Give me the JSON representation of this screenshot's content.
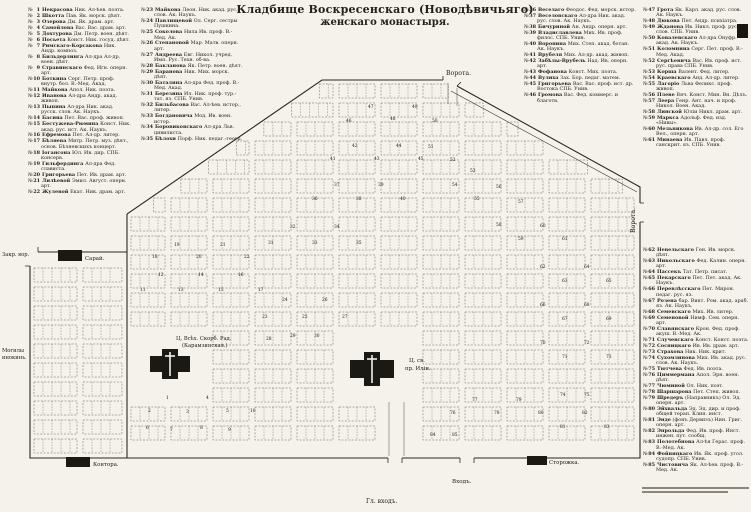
{
  "title": {
    "line1": "Кладбище Воскресенскаго (Новодѣвичьяго)",
    "line2": "женскаго монастыря."
  },
  "list_marker": "№",
  "columns": {
    "col1": {
      "from": 1,
      "to": 22
    },
    "col2": {
      "from": 23,
      "to": 35
    },
    "col3": {
      "from": 36,
      "to": 46
    },
    "col4a": {
      "from": 47,
      "to": 61
    },
    "col4b": {
      "from": 62,
      "to": 85
    }
  },
  "graves": [
    {
      "n": 1,
      "name": "Некрасова",
      "info": "Ник. Ал-ѣев. поэта."
    },
    {
      "n": 2,
      "name": "Шкотта",
      "info": "Пав. Як. морск. дѣят."
    },
    {
      "n": 3,
      "name": "Озерова",
      "info": "Дм. Як. драм. арт."
    },
    {
      "n": 4,
      "name": "Самойлова",
      "info": "Вас. Вас. драм. арт."
    },
    {
      "n": 5,
      "name": "Дохтурова",
      "info": "Дм. Петр. воен. дѣят."
    },
    {
      "n": 6,
      "name": "Посьета",
      "info": "Конст. Ник. госуд. дѣят."
    },
    {
      "n": 7,
      "name": "Римскаго-Корсакова",
      "info": "Ник. Андр. композ."
    },
    {
      "n": 8,
      "name": "Бильдерлинга",
      "info": "Ал-дра Ал-др. воен. дѣят."
    },
    {
      "n": 9,
      "name": "Стравинскаго",
      "info": "Фед. Игн. оперн. арт."
    },
    {
      "n": 10,
      "name": "Боткина",
      "info": "Серг. Петр. проф. внутр. бол. В.-Мед. Акад."
    },
    {
      "n": 11,
      "name": "Майкова",
      "info": "Апол. Ник. поэта."
    },
    {
      "n": 12,
      "name": "Иванова",
      "info": "Ал-дра Андр. акад. живоп."
    },
    {
      "n": 13,
      "name": "Пыпина",
      "info": "Ал-дра Ник. акад. русск. слов. Ак. Наукъ."
    },
    {
      "n": 14,
      "name": "Басина",
      "info": "Пет. Вас. проф. живоп."
    },
    {
      "n": 15,
      "name": "Бестужева-Рюмина",
      "info": "Конст. Ник. акад. рус. ист. Ак. Наукъ."
    },
    {
      "n": 16,
      "name": "Ефремова",
      "info": "Пет. Ал-др. литер."
    },
    {
      "n": 17,
      "name": "Бѣляева",
      "info": "Митр. Петр. муз. дѣят., основ. Бѣляевскихъ концерт."
    },
    {
      "n": 18,
      "name": "Іогансона",
      "info": "Юл. Ив. дир. СПБ. консерв."
    },
    {
      "n": 19,
      "name": "Гильфердинга",
      "info": "Ал-дра Фед. слависта."
    },
    {
      "n": 20,
      "name": "Григорьева",
      "info": "Пет. Ив. драм. арт."
    },
    {
      "n": 21,
      "name": "Лилѣевой",
      "info": "Эмил. Август. оперн. арт."
    },
    {
      "n": 22,
      "name": "Жулевой",
      "info": "Екат. Ник. драм. арт."
    },
    {
      "n": 23,
      "name": "Майкова",
      "info": "Леон. Ник. акад. рус. слов. Ак. Наукъ."
    },
    {
      "n": 24,
      "name": "Павлищевой",
      "info": "Ол. Серг. сестры Пушкина."
    },
    {
      "n": 25,
      "name": "Соколова",
      "info": "Нила Ив. проф. В.-Мед. Ак."
    },
    {
      "n": 26,
      "name": "Степановой",
      "info": "Мар. Матв. оперн. арт."
    },
    {
      "n": 27,
      "name": "Андреева",
      "info": "Евг. Никол. учред. Имп. Рус. Техн. об-ва."
    },
    {
      "n": 28,
      "name": "Бакланова",
      "info": "Як. Петр. воен. дѣят."
    },
    {
      "n": 29,
      "name": "Баранова",
      "info": "Ник. Мих. морск. дѣят."
    },
    {
      "n": 30,
      "name": "Баталина",
      "info": "Ал-дра Фед. проф. В.-Мед. Акад."
    },
    {
      "n": 31,
      "name": "Березина",
      "info": "Ил. Ник. проф. тур.-тат. яз. СПБ. Унив."
    },
    {
      "n": 32,
      "name": "Бильбасова",
      "info": "Вас. Ал-ѣев. истор., литер."
    },
    {
      "n": 33,
      "name": "Богдановича",
      "info": "Мод. Ив. воен. истор."
    },
    {
      "n": 34,
      "name": "Боровиковскаго",
      "info": "Ал-дра Льв. цивилиста."
    },
    {
      "n": 35,
      "name": "Бѣлохи",
      "info": "Порф. Ник. педаг.-геогр."
    },
    {
      "n": 36,
      "name": "Веселаго",
      "info": "Феодос. Фед. морск. истор."
    },
    {
      "n": 37,
      "name": "Веселовскаго",
      "info": "Ал-дра Ник. акад. рус. слов. Ак. Наукъ."
    },
    {
      "n": 38,
      "name": "Бичуриной",
      "info": "Ан. Андр. оперн. арт."
    },
    {
      "n": 39,
      "name": "Владиславлева",
      "info": "Мих. Ив. проф. филос. СПБ. Унив."
    },
    {
      "n": 40,
      "name": "Воронина",
      "info": "Мих. Степ. акад. ботан. Ак. Наукъ."
    },
    {
      "n": 41,
      "name": "Врубеля",
      "info": "Мих. Ал-др. акад. живоп."
    },
    {
      "n": 42,
      "name": "Забѣлы-Врубель",
      "info": "Над. Ив. оперн. арт."
    },
    {
      "n": 43,
      "name": "Фофанова",
      "info": "Конст. Мих. поэта."
    },
    {
      "n": 44,
      "name": "Вулиха",
      "info": "Зах. Бор. педаг. матем."
    },
    {
      "n": 45,
      "name": "Григорьева",
      "info": "Вас. Вас. проф. ист. др. Востока СПБ. Унив."
    },
    {
      "n": 46,
      "name": "Громова",
      "info": "Вас. Фед. коммерс. и благотв."
    },
    {
      "n": 47,
      "name": "Грота",
      "info": "Як. Карл. акад. рус. слов. Ак. Наукъ."
    },
    {
      "n": 48,
      "name": "Дюкова",
      "info": "Пет. Андр. психіатра."
    },
    {
      "n": 49,
      "name": "Жданова",
      "info": "Ив. Никл. проф. рус. слов. СПБ. Унив."
    },
    {
      "n": 50,
      "name": "Ковалевскаго",
      "info": "Ал-дра Онуфр. акад. Ак. Наукъ."
    },
    {
      "n": 51,
      "name": "Коломнина",
      "info": "Серг. Пет. проф. В.-Мед. Акад."
    },
    {
      "n": 52,
      "name": "Сергѣевича",
      "info": "Вас. Ив. проф. ист. рус. права СПБ. Унив."
    },
    {
      "n": 53,
      "name": "Корша",
      "info": "Валент. Фед. литер."
    },
    {
      "n": 54,
      "name": "Краевскаго",
      "info": "Анд. Ал-др. литер."
    },
    {
      "n": 55,
      "name": "Лагоріо",
      "info": "Льва Феликс. проф. живоп."
    },
    {
      "n": 56,
      "name": "Плеве",
      "info": "Вяч. Конст. Мин. Вн. Дѣлъ."
    },
    {
      "n": 57,
      "name": "Леера",
      "info": "Генр. Ант. нач. и проф. Никол. Воен. Акад."
    },
    {
      "n": 58,
      "name": "Линской",
      "info": "Юліи Никл. драм. арт."
    },
    {
      "n": 59,
      "name": "Маркса",
      "info": "Адольф. Фед. изд. «Нивы»."
    },
    {
      "n": 60,
      "name": "Мельникова",
      "info": "Ив. Ал-др. сол. Его Вел., оперн. арт."
    },
    {
      "n": 61,
      "name": "Минаева",
      "info": "Ив. Павл. проф. санскрит. яз. СПБ. Унив."
    },
    {
      "n": 62,
      "name": "Невельскаго",
      "info": "Ген. Ив. морск. дѣят."
    },
    {
      "n": 63,
      "name": "Никольскаго",
      "info": "Фед. Калин. оперн. арт."
    },
    {
      "n": 64,
      "name": "Пассекъ",
      "info": "Тат. Петр. писат."
    },
    {
      "n": 65,
      "name": "Пекарскаго",
      "info": "Пет. Пет. акад. Ак. Наукъ."
    },
    {
      "n": 66,
      "name": "Перевлѣсскаго",
      "info": "Пет. Мирон. педаг. рус. яз."
    },
    {
      "n": 67,
      "name": "Розена",
      "info": "бар. Викт. Ром. акад. араб. яз. Ак. Наукъ."
    },
    {
      "n": 68,
      "name": "Семевскаго",
      "info": "Мих. Ив. литер."
    },
    {
      "n": 69,
      "name": "Семеновой",
      "info": "Нимф. Сем. оперн. арт."
    },
    {
      "n": 70,
      "name": "Славянскаго",
      "info": "Крон. Фед. проф. акуш. В.-Мед. Ак."
    },
    {
      "n": 71,
      "name": "Случевскаго",
      "info": "Конст. Конст. поэта."
    },
    {
      "n": 72,
      "name": "Сосницкаго",
      "info": "Ив. Ив. драм. арт."
    },
    {
      "n": 73,
      "name": "Страхова",
      "info": "Ник. Ник. крит."
    },
    {
      "n": 74,
      "name": "Сухомлинова",
      "info": "Мих. Ив. акад. рус. слов. Ак. Наукъ."
    },
    {
      "n": 75,
      "name": "Тютчева",
      "info": "Фед. Ив. поэта."
    },
    {
      "n": 76,
      "name": "Циммермана",
      "info": "Апол. Эрн. воен. дѣят."
    },
    {
      "n": 77,
      "name": "Чюминой",
      "info": "Ол. Ник. поэт."
    },
    {
      "n": 78,
      "name": "Шаршарова",
      "info": "Пет. Степ. живоп."
    },
    {
      "n": 79,
      "name": "Шредеръ",
      "info": "(Направникъ) Ол. Эд. оперн. арт."
    },
    {
      "n": 80,
      "name": "Эйхвальда",
      "info": "Эд. Эд. дир. и проф. общей терап. Клин. инст."
    },
    {
      "n": 81,
      "name": "Энде",
      "info": "(фонъ Дервизъ) Нин. Григ. оперн. арт."
    },
    {
      "n": 82,
      "name": "Энрольда",
      "info": "Фед. Ив. проф. Инст. инжен. пут. сообщ."
    },
    {
      "n": 83,
      "name": "Полотебнова",
      "info": "Ал-ѣя Герас. проф. В.-Мед. Ак."
    },
    {
      "n": 84,
      "name": "Фойницкаго",
      "info": "Ив. Як. проф. угол. судопр. СПБ. Унив."
    },
    {
      "n": 85,
      "name": "Чистовича",
      "info": "Як. Ал-ѣев. проф. В.-Мед. Ак."
    }
  ],
  "map": {
    "labels": [
      {
        "id": "gate-top",
        "text": "Ворота.",
        "x": 446,
        "y": 75,
        "size": 6.2,
        "rot": 0
      },
      {
        "id": "gate-right",
        "text": "Ворота.",
        "x": 635,
        "y": 233,
        "size": 6.2,
        "rot": -90
      },
      {
        "id": "closed-gate",
        "text": "Закр. вор.",
        "x": 2,
        "y": 256,
        "size": 5.2,
        "rot": 0
      },
      {
        "id": "shed",
        "text": "Сарай.",
        "x": 85,
        "y": 260,
        "size": 5.4,
        "rot": 0
      },
      {
        "id": "nun-graves-1",
        "text": "Могилы",
        "x": 2,
        "y": 352,
        "size": 5.2,
        "rot": 0
      },
      {
        "id": "nun-graves-2",
        "text": "инокинь.",
        "x": 2,
        "y": 359,
        "size": 5.2,
        "rot": 0
      },
      {
        "id": "church1-name",
        "text": "Ц. Всѣх. Скорб. Рад.",
        "x": 176,
        "y": 340,
        "size": 5.2,
        "rot": 0
      },
      {
        "id": "church1-alt",
        "text": "(Карамзинская.)",
        "x": 182,
        "y": 347,
        "size": 5.2,
        "rot": 0
      },
      {
        "id": "church2-name-1",
        "text": "Ц. св.",
        "x": 409,
        "y": 362,
        "size": 5.4,
        "rot": 0
      },
      {
        "id": "church2-name-2",
        "text": "пр. Иліи.",
        "x": 405,
        "y": 370,
        "size": 5.4,
        "rot": 0
      },
      {
        "id": "office",
        "text": "Контора.",
        "x": 93,
        "y": 466,
        "size": 5.4,
        "rot": 0
      },
      {
        "id": "watchhouse",
        "text": "Сторожка.",
        "x": 549,
        "y": 464,
        "size": 5.4,
        "rot": 0
      },
      {
        "id": "entrance",
        "text": "Входъ.",
        "x": 452,
        "y": 483,
        "size": 5.6,
        "rot": 0
      },
      {
        "id": "main-entrance",
        "text": "Гл. входъ.",
        "x": 366,
        "y": 503,
        "size": 6,
        "rot": 0
      }
    ],
    "numbers": [
      {
        "n": 1,
        "x": 166,
        "y": 399
      },
      {
        "n": 2,
        "x": 148,
        "y": 412
      },
      {
        "n": 3,
        "x": 186,
        "y": 413
      },
      {
        "n": 4,
        "x": 206,
        "y": 399
      },
      {
        "n": 5,
        "x": 226,
        "y": 412
      },
      {
        "n": 6,
        "x": 146,
        "y": 429
      },
      {
        "n": 7,
        "x": 170,
        "y": 431
      },
      {
        "n": 8,
        "x": 200,
        "y": 429
      },
      {
        "n": 9,
        "x": 228,
        "y": 431
      },
      {
        "n": 10,
        "x": 250,
        "y": 412
      },
      {
        "n": 11,
        "x": 140,
        "y": 291
      },
      {
        "n": 12,
        "x": 158,
        "y": 276
      },
      {
        "n": 13,
        "x": 178,
        "y": 291
      },
      {
        "n": 14,
        "x": 198,
        "y": 276
      },
      {
        "n": 15,
        "x": 218,
        "y": 291
      },
      {
        "n": 16,
        "x": 238,
        "y": 276
      },
      {
        "n": 17,
        "x": 258,
        "y": 291
      },
      {
        "n": 18,
        "x": 152,
        "y": 258
      },
      {
        "n": 19,
        "x": 174,
        "y": 246
      },
      {
        "n": 20,
        "x": 196,
        "y": 258
      },
      {
        "n": 21,
        "x": 220,
        "y": 246
      },
      {
        "n": 22,
        "x": 244,
        "y": 258
      },
      {
        "n": 23,
        "x": 262,
        "y": 318
      },
      {
        "n": 24,
        "x": 282,
        "y": 301
      },
      {
        "n": 25,
        "x": 302,
        "y": 318
      },
      {
        "n": 26,
        "x": 322,
        "y": 301
      },
      {
        "n": 27,
        "x": 342,
        "y": 318
      },
      {
        "n": 28,
        "x": 266,
        "y": 340
      },
      {
        "n": 29,
        "x": 290,
        "y": 337
      },
      {
        "n": 30,
        "x": 314,
        "y": 337
      },
      {
        "n": 31,
        "x": 268,
        "y": 244
      },
      {
        "n": 32,
        "x": 290,
        "y": 228
      },
      {
        "n": 33,
        "x": 312,
        "y": 244
      },
      {
        "n": 34,
        "x": 334,
        "y": 228
      },
      {
        "n": 35,
        "x": 356,
        "y": 244
      },
      {
        "n": 36,
        "x": 312,
        "y": 200
      },
      {
        "n": 37,
        "x": 334,
        "y": 186
      },
      {
        "n": 38,
        "x": 356,
        "y": 200
      },
      {
        "n": 39,
        "x": 378,
        "y": 186
      },
      {
        "n": 40,
        "x": 400,
        "y": 200
      },
      {
        "n": 41,
        "x": 330,
        "y": 160
      },
      {
        "n": 42,
        "x": 352,
        "y": 147
      },
      {
        "n": 43,
        "x": 374,
        "y": 160
      },
      {
        "n": 44,
        "x": 396,
        "y": 147
      },
      {
        "n": 45,
        "x": 418,
        "y": 160
      },
      {
        "n": 46,
        "x": 346,
        "y": 122
      },
      {
        "n": 47,
        "x": 368,
        "y": 108
      },
      {
        "n": 48,
        "x": 390,
        "y": 120
      },
      {
        "n": 49,
        "x": 412,
        "y": 108
      },
      {
        "n": 50,
        "x": 432,
        "y": 122
      },
      {
        "n": 51,
        "x": 428,
        "y": 148
      },
      {
        "n": 52,
        "x": 450,
        "y": 161
      },
      {
        "n": 53,
        "x": 470,
        "y": 172
      },
      {
        "n": 54,
        "x": 452,
        "y": 186
      },
      {
        "n": 55,
        "x": 474,
        "y": 200
      },
      {
        "n": 56,
        "x": 496,
        "y": 188
      },
      {
        "n": 57,
        "x": 518,
        "y": 203
      },
      {
        "n": 58,
        "x": 496,
        "y": 226
      },
      {
        "n": 59,
        "x": 518,
        "y": 240
      },
      {
        "n": 60,
        "x": 540,
        "y": 227
      },
      {
        "n": 61,
        "x": 562,
        "y": 240
      },
      {
        "n": 62,
        "x": 540,
        "y": 268
      },
      {
        "n": 63,
        "x": 562,
        "y": 282
      },
      {
        "n": 64,
        "x": 584,
        "y": 268
      },
      {
        "n": 65,
        "x": 606,
        "y": 282
      },
      {
        "n": 66,
        "x": 540,
        "y": 306
      },
      {
        "n": 67,
        "x": 562,
        "y": 320
      },
      {
        "n": 68,
        "x": 584,
        "y": 306
      },
      {
        "n": 69,
        "x": 606,
        "y": 320
      },
      {
        "n": 70,
        "x": 540,
        "y": 344
      },
      {
        "n": 71,
        "x": 562,
        "y": 358
      },
      {
        "n": 72,
        "x": 584,
        "y": 344
      },
      {
        "n": 73,
        "x": 606,
        "y": 358
      },
      {
        "n": 74,
        "x": 560,
        "y": 396
      },
      {
        "n": 75,
        "x": 584,
        "y": 396
      },
      {
        "n": 76,
        "x": 450,
        "y": 414
      },
      {
        "n": 77,
        "x": 472,
        "y": 401
      },
      {
        "n": 78,
        "x": 494,
        "y": 414
      },
      {
        "n": 79,
        "x": 516,
        "y": 401
      },
      {
        "n": 80,
        "x": 538,
        "y": 414
      },
      {
        "n": 81,
        "x": 560,
        "y": 428
      },
      {
        "n": 82,
        "x": 582,
        "y": 414
      },
      {
        "n": 83,
        "x": 604,
        "y": 428
      },
      {
        "n": 84,
        "x": 430,
        "y": 436
      },
      {
        "n": 85,
        "x": 452,
        "y": 436
      }
    ]
  },
  "colors": {
    "paper": "#f4f2eb",
    "ink": "#23211c",
    "wall": "#2b2822",
    "plot_line": "#6b6558",
    "building": "#1b1914"
  }
}
